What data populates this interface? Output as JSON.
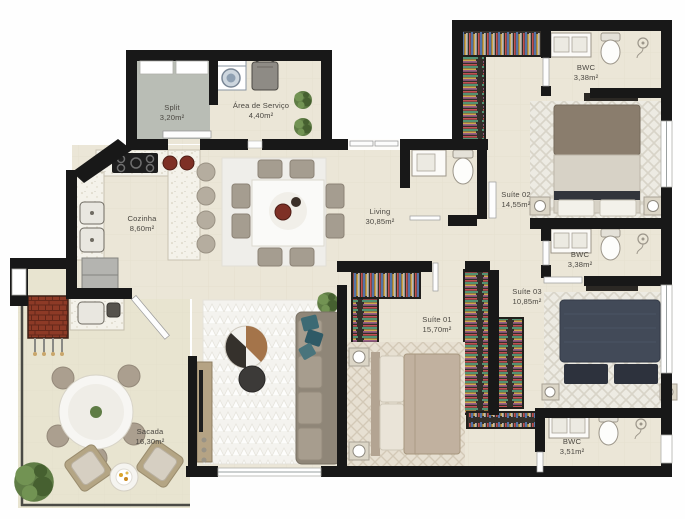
{
  "plan": {
    "type": "apartment-floor-plan",
    "rooms": [
      {
        "name": "Split",
        "area": "3,20m²"
      },
      {
        "name": "Área de Serviço",
        "area": "4,40m²"
      },
      {
        "name": "Cozinha",
        "area": "8,60m²"
      },
      {
        "name": "Living",
        "area": "30,85m²"
      },
      {
        "name": "Sacada",
        "area": "16,30m²"
      },
      {
        "name": "Suíte 01",
        "area": "15,70m²"
      },
      {
        "name": "Suíte 02",
        "area": "14,55m²"
      },
      {
        "name": "Suíte 03",
        "area": "10,85m²"
      },
      {
        "name": "BWC",
        "area": "3,38m²"
      },
      {
        "name": "BWC",
        "area": "3,38m²"
      },
      {
        "name": "BWC",
        "area": "3,51m²"
      }
    ],
    "colors": {
      "wall": "#181818",
      "floor": "#ebe6d7",
      "balcony_floor": "#e8e4d0",
      "split_floor": "#b9bdb5",
      "wood": "#a4744a",
      "bed_navy": "#424a58",
      "bed_taupe": "#8a7d6d",
      "grill_brick": "#8d3a26",
      "plant_green": "#5f7c45"
    }
  }
}
